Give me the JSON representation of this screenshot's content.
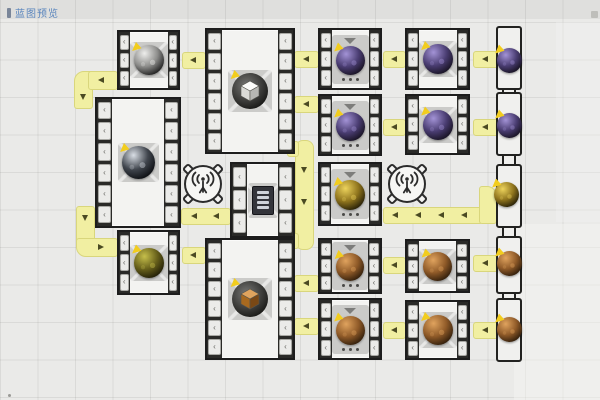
{
  "app": {
    "title_label": "蓝图预览"
  },
  "ui": {
    "slot_glyph": "‹"
  },
  "colors": {
    "background": "#eaeae8",
    "belt": "#f1efa2",
    "belt_edge": "#d9d67c",
    "machine_border": "#1d1d1d",
    "badge": "#f2cd1e",
    "label_blue": "#5a85bd",
    "orb_palettes": {
      "purple": [
        "#a393d6",
        "#4a3d72",
        "#171221"
      ],
      "gold": [
        "#edd35c",
        "#8f741d",
        "#251e07"
      ],
      "copper": [
        "#e0a35e",
        "#8f5a28",
        "#2f1d0b"
      ],
      "silver": [
        "#eeeeec",
        "#8d8d8b",
        "#1d1d1d"
      ],
      "black": [
        "#d9dee5",
        "#40454d",
        "#0b0d11"
      ],
      "olive": [
        "#c6bf4b",
        "#665f1a",
        "#1f1c06"
      ]
    },
    "cube_palettes": {
      "white_cube": [
        "#fcfcfa",
        "#dadad6",
        "#b7b7b3"
      ],
      "brown_cube": [
        "#e0a45e",
        "#a8691f",
        "#7a4815"
      ]
    }
  },
  "machines": [
    {
      "id": "L1",
      "x": 117,
      "y": 30,
      "w": 63,
      "h": 60,
      "slots": 3,
      "icon": "orb",
      "palette": "silver",
      "tile": "workshop",
      "badge": true,
      "size": 30
    },
    {
      "id": "L2",
      "x": 95,
      "y": 97,
      "w": 86,
      "h": 131,
      "slots": 6,
      "icon": "orb",
      "palette": "black",
      "tile": "workshop",
      "badge": true,
      "size": 33
    },
    {
      "id": "L3",
      "x": 117,
      "y": 230,
      "w": 63,
      "h": 65,
      "slots": 3,
      "icon": "orb",
      "palette": "olive",
      "tile": "workshop",
      "badge": true,
      "size": 30
    },
    {
      "id": "M2",
      "x": 205,
      "y": 28,
      "w": 90,
      "h": 126,
      "slots": 6,
      "icon": "cube",
      "palette": "white_cube",
      "tile": "workshop",
      "badge": true,
      "size": 36
    },
    {
      "id": "M3",
      "x": 230,
      "y": 162,
      "w": 65,
      "h": 76,
      "slots": 3,
      "icon": "chip",
      "palette": "",
      "tile": "workshop",
      "badge": false,
      "size": 30
    },
    {
      "id": "M4",
      "x": 205,
      "y": 238,
      "w": 90,
      "h": 122,
      "slots": 6,
      "icon": "cube",
      "palette": "brown_cube",
      "tile": "workshop",
      "badge": true,
      "size": 36
    },
    {
      "id": "A1",
      "x": 318,
      "y": 28,
      "w": 64,
      "h": 62,
      "slots": 3,
      "icon": "orb",
      "palette": "purple",
      "tile": "furnace",
      "badge": true,
      "size": 29
    },
    {
      "id": "A2",
      "x": 318,
      "y": 94,
      "w": 64,
      "h": 62,
      "slots": 3,
      "icon": "orb",
      "palette": "purple",
      "tile": "furnace",
      "badge": true,
      "size": 29
    },
    {
      "id": "A3",
      "x": 318,
      "y": 162,
      "w": 64,
      "h": 64,
      "slots": 3,
      "icon": "orb",
      "palette": "gold",
      "tile": "furnace",
      "badge": true,
      "size": 30
    },
    {
      "id": "A4",
      "x": 318,
      "y": 238,
      "w": 64,
      "h": 56,
      "slots": 3,
      "icon": "orb",
      "palette": "copper",
      "tile": "furnace",
      "badge": true,
      "size": 28
    },
    {
      "id": "A5",
      "x": 318,
      "y": 298,
      "w": 64,
      "h": 62,
      "slots": 3,
      "icon": "orb",
      "palette": "copper",
      "tile": "furnace",
      "badge": true,
      "size": 29
    },
    {
      "id": "B1",
      "x": 405,
      "y": 28,
      "w": 65,
      "h": 62,
      "slots": 3,
      "icon": "orb",
      "palette": "purple",
      "tile": "workshop",
      "badge": true,
      "size": 30
    },
    {
      "id": "B2",
      "x": 405,
      "y": 94,
      "w": 65,
      "h": 61,
      "slots": 3,
      "icon": "orb",
      "palette": "purple",
      "tile": "workshop",
      "badge": true,
      "size": 30
    },
    {
      "id": "B4",
      "x": 405,
      "y": 239,
      "w": 65,
      "h": 54,
      "slots": 3,
      "icon": "orb",
      "palette": "copper",
      "tile": "workshop",
      "badge": true,
      "size": 29
    },
    {
      "id": "B5",
      "x": 405,
      "y": 300,
      "w": 65,
      "h": 60,
      "slots": 3,
      "icon": "orb",
      "palette": "copper",
      "tile": "workshop",
      "badge": true,
      "size": 30
    }
  ],
  "belts": [
    {
      "id": "elbow-top-left",
      "segments": [
        {
          "x": 74,
          "y": 71,
          "w": 19,
          "h": 38,
          "r": "10px 3px 3px 3px"
        },
        {
          "x": 88,
          "y": 71,
          "w": 30,
          "h": 19,
          "r": "3px"
        }
      ],
      "arrows": [
        {
          "x": 101,
          "y": 80,
          "dir": "left"
        },
        {
          "x": 83,
          "y": 97,
          "dir": "down"
        }
      ]
    },
    {
      "id": "elbow-mid-left",
      "segments": [
        {
          "x": 76,
          "y": 206,
          "w": 19,
          "h": 44,
          "r": "3px 3px 3px 10px"
        },
        {
          "x": 76,
          "y": 238,
          "w": 42,
          "h": 19,
          "r": "3px 3px 3px 10px"
        }
      ],
      "arrows": [
        {
          "x": 85,
          "y": 218,
          "dir": "down"
        },
        {
          "x": 101,
          "y": 247,
          "dir": "right"
        }
      ]
    },
    {
      "id": "b-L1-M2",
      "segments": [
        {
          "x": 182,
          "y": 52,
          "w": 24,
          "h": 17,
          "r": "3px"
        }
      ],
      "arrows": [
        {
          "x": 193,
          "y": 60,
          "dir": "left"
        }
      ]
    },
    {
      "id": "b-M2-A1",
      "segments": [
        {
          "x": 294,
          "y": 51,
          "w": 25,
          "h": 17,
          "r": "3px"
        }
      ],
      "arrows": [
        {
          "x": 306,
          "y": 59,
          "dir": "left"
        }
      ]
    },
    {
      "id": "b-M2-A2",
      "segments": [
        {
          "x": 294,
          "y": 96,
          "w": 25,
          "h": 17,
          "r": "3px"
        }
      ],
      "arrows": [
        {
          "x": 306,
          "y": 104,
          "dir": "left"
        }
      ]
    },
    {
      "id": "b-A1-B1",
      "segments": [
        {
          "x": 383,
          "y": 51,
          "w": 23,
          "h": 17,
          "r": "3px"
        }
      ],
      "arrows": [
        {
          "x": 394,
          "y": 59,
          "dir": "left"
        }
      ]
    },
    {
      "id": "b-A2-B2",
      "segments": [
        {
          "x": 383,
          "y": 119,
          "w": 23,
          "h": 17,
          "r": "3px"
        }
      ],
      "arrows": [
        {
          "x": 394,
          "y": 127,
          "dir": "left"
        }
      ]
    },
    {
      "id": "b-B1-out",
      "segments": [
        {
          "x": 473,
          "y": 51,
          "w": 26,
          "h": 17,
          "r": "3px"
        }
      ],
      "arrows": [
        {
          "x": 485,
          "y": 59,
          "dir": "left"
        }
      ]
    },
    {
      "id": "b-B2-out",
      "segments": [
        {
          "x": 473,
          "y": 119,
          "w": 26,
          "h": 17,
          "r": "3px"
        }
      ],
      "arrows": [
        {
          "x": 485,
          "y": 127,
          "dir": "left"
        }
      ]
    },
    {
      "id": "b-station1",
      "segments": [
        {
          "x": 181,
          "y": 208,
          "w": 50,
          "h": 17,
          "r": "3px"
        }
      ],
      "arrows": [
        {
          "x": 194,
          "y": 216,
          "dir": "left"
        },
        {
          "x": 216,
          "y": 216,
          "dir": "left"
        }
      ]
    },
    {
      "id": "b-row3-long",
      "segments": [
        {
          "x": 383,
          "y": 207,
          "w": 100,
          "h": 17,
          "r": "3px"
        },
        {
          "x": 479,
          "y": 186,
          "w": 18,
          "h": 38,
          "r": "3px 10px 3px 3px"
        }
      ],
      "arrows": [
        {
          "x": 395,
          "y": 215,
          "dir": "left"
        },
        {
          "x": 418,
          "y": 215,
          "dir": "left"
        },
        {
          "x": 441,
          "y": 215,
          "dir": "left"
        },
        {
          "x": 464,
          "y": 215,
          "dir": "left"
        }
      ]
    },
    {
      "id": "b-c-vertical",
      "segments": [
        {
          "x": 295,
          "y": 140,
          "w": 19,
          "h": 110,
          "r": "8px"
        },
        {
          "x": 287,
          "y": 141,
          "w": 12,
          "h": 16,
          "r": "3px"
        },
        {
          "x": 287,
          "y": 233,
          "w": 12,
          "h": 16,
          "r": "3px"
        }
      ],
      "arrows": [
        {
          "x": 304,
          "y": 170,
          "dir": "down"
        },
        {
          "x": 304,
          "y": 202,
          "dir": "down"
        }
      ]
    },
    {
      "id": "b-L3-M4",
      "segments": [
        {
          "x": 182,
          "y": 247,
          "w": 24,
          "h": 17,
          "r": "3px"
        }
      ],
      "arrows": [
        {
          "x": 193,
          "y": 255,
          "dir": "left"
        }
      ]
    },
    {
      "id": "b-M4-A4",
      "segments": [
        {
          "x": 294,
          "y": 275,
          "w": 25,
          "h": 17,
          "r": "3px"
        }
      ],
      "arrows": [
        {
          "x": 306,
          "y": 283,
          "dir": "left"
        }
      ]
    },
    {
      "id": "b-M4-A5",
      "segments": [
        {
          "x": 294,
          "y": 318,
          "w": 25,
          "h": 17,
          "r": "3px"
        }
      ],
      "arrows": [
        {
          "x": 306,
          "y": 326,
          "dir": "left"
        }
      ]
    },
    {
      "id": "b-A4-B4",
      "segments": [
        {
          "x": 383,
          "y": 257,
          "w": 23,
          "h": 17,
          "r": "3px"
        }
      ],
      "arrows": [
        {
          "x": 394,
          "y": 265,
          "dir": "left"
        }
      ]
    },
    {
      "id": "b-A5-B5",
      "segments": [
        {
          "x": 383,
          "y": 322,
          "w": 23,
          "h": 17,
          "r": "3px"
        }
      ],
      "arrows": [
        {
          "x": 394,
          "y": 330,
          "dir": "left"
        }
      ]
    },
    {
      "id": "b-B4-out",
      "segments": [
        {
          "x": 473,
          "y": 255,
          "w": 26,
          "h": 17,
          "r": "3px"
        }
      ],
      "arrows": [
        {
          "x": 485,
          "y": 263,
          "dir": "left"
        }
      ]
    },
    {
      "id": "b-B5-out",
      "segments": [
        {
          "x": 473,
          "y": 322,
          "w": 26,
          "h": 17,
          "r": "3px"
        }
      ],
      "arrows": [
        {
          "x": 485,
          "y": 330,
          "dir": "left"
        }
      ]
    }
  ],
  "stations": [
    {
      "id": "station-1",
      "cx": 203,
      "cy": 184,
      "d": 38
    },
    {
      "id": "station-2",
      "cx": 407,
      "cy": 184,
      "d": 38
    }
  ],
  "output_column": {
    "housing_x": 496,
    "housing_w": 26,
    "rows": [
      {
        "id": "out-1",
        "y": 26,
        "h": 64,
        "orb_cx": 509,
        "orb_cy": 60,
        "palette": "purple"
      },
      {
        "id": "out-2",
        "y": 92,
        "h": 64,
        "orb_cx": 509,
        "orb_cy": 125,
        "palette": "purple"
      },
      {
        "id": "out-3",
        "y": 164,
        "h": 64,
        "orb_cx": 506,
        "orb_cy": 194,
        "palette": "gold"
      },
      {
        "id": "out-4",
        "y": 236,
        "h": 58,
        "orb_cx": 509,
        "orb_cy": 263,
        "palette": "copper"
      },
      {
        "id": "out-5",
        "y": 298,
        "h": 64,
        "orb_cx": 509,
        "orb_cy": 329,
        "palette": "copper"
      }
    ],
    "necks": [
      {
        "x": 502,
        "y": 86,
        "w": 14,
        "h": 10
      },
      {
        "x": 502,
        "y": 152,
        "w": 14,
        "h": 16
      },
      {
        "x": 502,
        "y": 224,
        "w": 14,
        "h": 16
      },
      {
        "x": 502,
        "y": 290,
        "w": 14,
        "h": 12
      }
    ],
    "orb_size": 25
  },
  "patches": [
    {
      "x": 514,
      "y": 224,
      "w": 86,
      "h": 176,
      "opacity": 0.45
    },
    {
      "x": 556,
      "y": 22,
      "w": 44,
      "h": 200,
      "opacity": 0.3
    }
  ],
  "markers": {
    "corner": {
      "x": 591,
      "y": 11
    },
    "dot": {
      "x": 8,
      "y": 394
    }
  }
}
